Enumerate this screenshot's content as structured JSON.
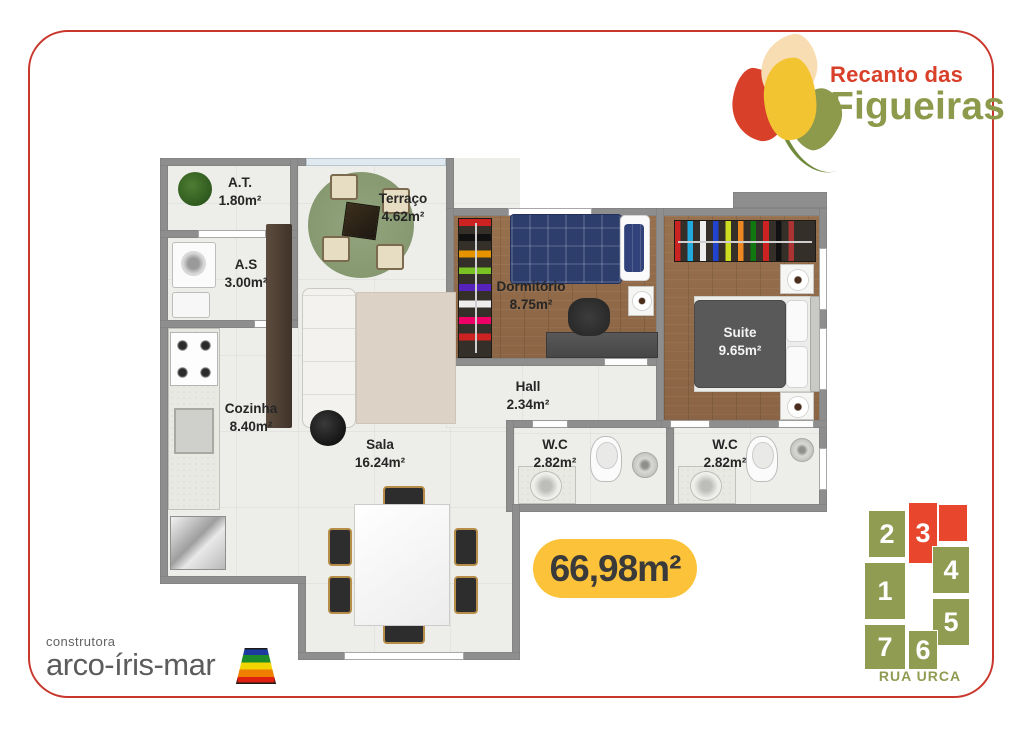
{
  "brand": {
    "line1": "Recanto das",
    "line2": "Figueiras"
  },
  "badge": {
    "total_area": "66,98m²"
  },
  "rooms": [
    {
      "name": "A.T.",
      "area": "1.80m²"
    },
    {
      "name": "A.S",
      "area": "3.00m²"
    },
    {
      "name": "Terraço",
      "area": "4.62m²"
    },
    {
      "name": "Dormitório",
      "area": "8.75m²"
    },
    {
      "name": "Suite",
      "area": "9.65m²"
    },
    {
      "name": "Hall",
      "area": "2.34m²"
    },
    {
      "name": "Cozinha",
      "area": "8.40m²"
    },
    {
      "name": "Sala",
      "area": "16.24m²"
    },
    {
      "name": "W.C",
      "area": "2.82m²"
    },
    {
      "name": "W.C",
      "area": "2.82m²"
    }
  ],
  "builder": {
    "prefix": "construtora",
    "name": "arco-íris-mar"
  },
  "keyplan": {
    "street": "RUA URCA",
    "highlighted_unit": "3",
    "units": [
      {
        "n": "1"
      },
      {
        "n": "2"
      },
      {
        "n": "3"
      },
      {
        "n": "4"
      },
      {
        "n": "5"
      },
      {
        "n": "6"
      },
      {
        "n": "7"
      }
    ]
  },
  "colors": {
    "accent_red": "#d8402a",
    "olive_green": "#8d9a4c",
    "badge_yellow": "#fcc33a",
    "keyplan_highlight": "#e8472e",
    "wall_gray": "#8e8e8e"
  }
}
